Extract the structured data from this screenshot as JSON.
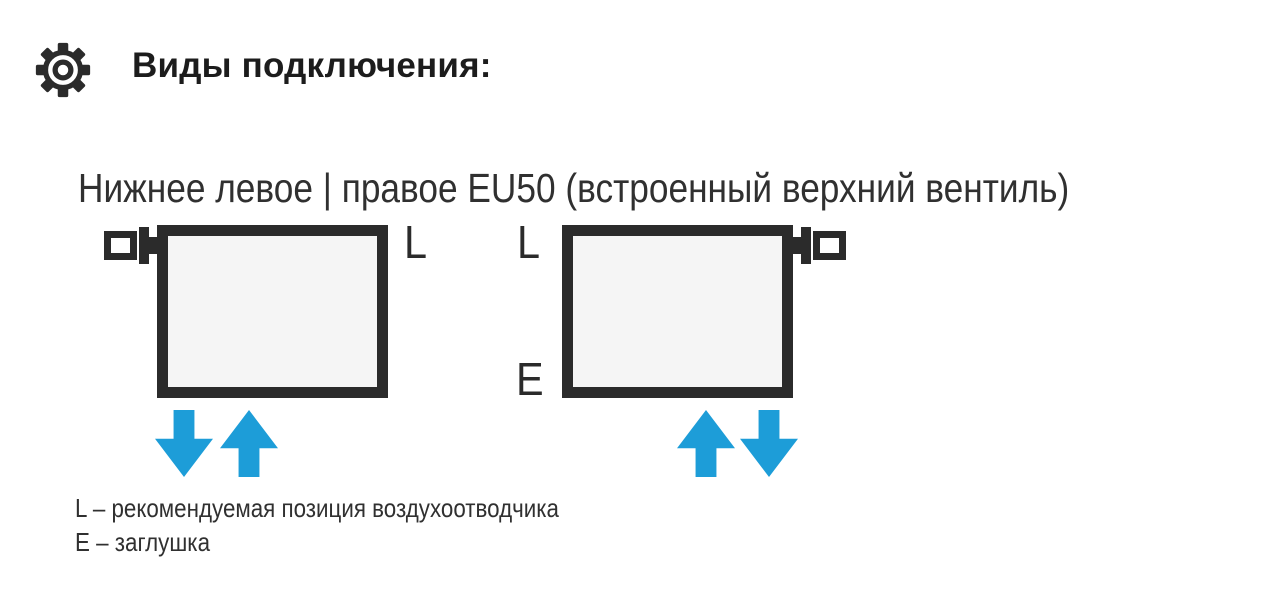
{
  "header": {
    "icon": "gear-icon",
    "title": "Виды подключения:"
  },
  "subtitle": "Нижнее левое | правое EU50 (встроенный верхний вентиль)",
  "diagrams": [
    {
      "id": "bottom-left-connection",
      "valve_side": "left",
      "air_vent_label": "L",
      "arrows": [
        "down",
        "up"
      ]
    },
    {
      "id": "bottom-right-connection",
      "valve_side": "right",
      "air_vent_label": "L",
      "plug_label": "E",
      "arrows": [
        "up",
        "down"
      ]
    }
  ],
  "legend": [
    "L – рекомендуемая позиция воздухоотводчика",
    "E – заглушка"
  ],
  "colors": {
    "dark": "#2b2b2b",
    "arrow_blue": "#1d9dd8",
    "radiator_fill": "#f5f5f5"
  }
}
